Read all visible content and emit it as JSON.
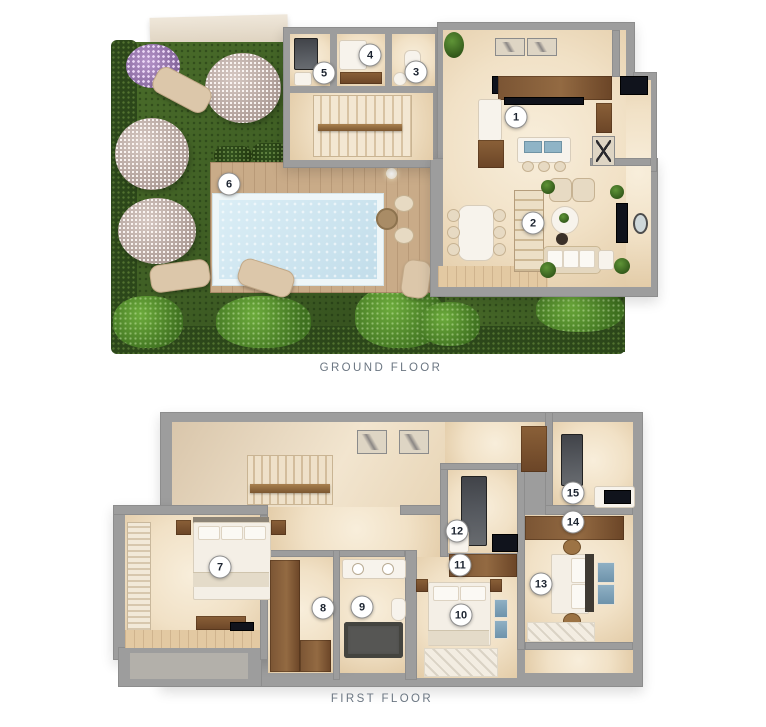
{
  "floors": [
    {
      "id": "ground",
      "label": "GROUND FLOOR",
      "markers": [
        {
          "n": "1",
          "x": 516,
          "y": 117
        },
        {
          "n": "2",
          "x": 533,
          "y": 223
        },
        {
          "n": "3",
          "x": 416,
          "y": 72
        },
        {
          "n": "4",
          "x": 370,
          "y": 55
        },
        {
          "n": "5",
          "x": 324,
          "y": 73
        },
        {
          "n": "6",
          "x": 229,
          "y": 184
        }
      ]
    },
    {
      "id": "first",
      "label": "FIRST FLOOR",
      "markers": [
        {
          "n": "7",
          "x": 220,
          "y": 567
        },
        {
          "n": "8",
          "x": 323,
          "y": 608
        },
        {
          "n": "9",
          "x": 362,
          "y": 607
        },
        {
          "n": "10",
          "x": 461,
          "y": 615
        },
        {
          "n": "11",
          "x": 460,
          "y": 565
        },
        {
          "n": "12",
          "x": 457,
          "y": 531
        },
        {
          "n": "13",
          "x": 541,
          "y": 584
        },
        {
          "n": "14",
          "x": 573,
          "y": 522
        },
        {
          "n": "15",
          "x": 573,
          "y": 493
        }
      ]
    }
  ],
  "colors": {
    "wall": "#9d9d9d",
    "floor": "#f2e3ca",
    "grass": "#3e5f24",
    "hedge": "#2c471a",
    "pool_water": "#cde6f1",
    "deck_wood": "#c9ab88",
    "furniture_wood": "#7b5534",
    "accent_black": "#10131c",
    "label_text": "#6b7682",
    "marker_border": "#8f8f8f"
  }
}
